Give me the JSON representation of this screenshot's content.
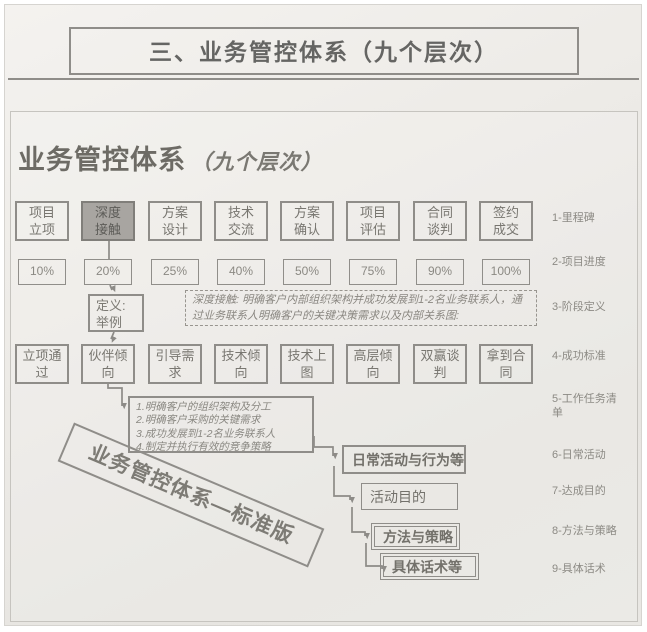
{
  "page": {
    "title": "三、业务管控体系（九个层次）",
    "heading": "业务管控体系",
    "heading_suffix": "（九个层次）"
  },
  "stages": [
    {
      "label": "项目\n立项",
      "progress": "10%"
    },
    {
      "label": "深度\n接触",
      "progress": "20%",
      "highlighted": true
    },
    {
      "label": "方案\n设计",
      "progress": "25%"
    },
    {
      "label": "技术\n交流",
      "progress": "40%"
    },
    {
      "label": "方案\n确认",
      "progress": "50%"
    },
    {
      "label": "项目\n评估",
      "progress": "75%"
    },
    {
      "label": "合同\n谈判",
      "progress": "90%"
    },
    {
      "label": "签约\n成交",
      "progress": "100%"
    }
  ],
  "definition_box": "定义:\n举例",
  "deep_contact_note": "深度接触: 明确客户内部组织架构并成功发展到1-2名业务联系人，通过业务联系人明确客户的关键决策需求以及内部关系图:",
  "success_criteria": [
    "立项通\n过",
    "伙伴倾\n向",
    "引导需\n求",
    "技术倾\n向",
    "技术上\n图",
    "高层倾\n向",
    "双赢谈\n判",
    "拿到合\n同"
  ],
  "task_list": "1.明确客户的组织架构及分工\n2.明确客户采购的关键需求\n3.成功发展到1-2名业务联系人\n4.制定并执行有效的竞争策略",
  "banner": "业务管控体系—标准版",
  "cascade": [
    "日常活动与行为等",
    "活动目的",
    "方法与策略",
    "具体话术等"
  ],
  "levels": [
    "1-里程碑",
    "2-项目进度",
    "3-阶段定义",
    "4-成功标准",
    "5-工作任务清\n单",
    "6-日常活动",
    "7-达成目的",
    "8-方法与策略",
    "9-具体话术"
  ],
  "colors": {
    "line": "#8d8b87",
    "box_border": "#8f8d89",
    "highlight_fill": "#a8a5a1",
    "title_text": "#656563"
  }
}
